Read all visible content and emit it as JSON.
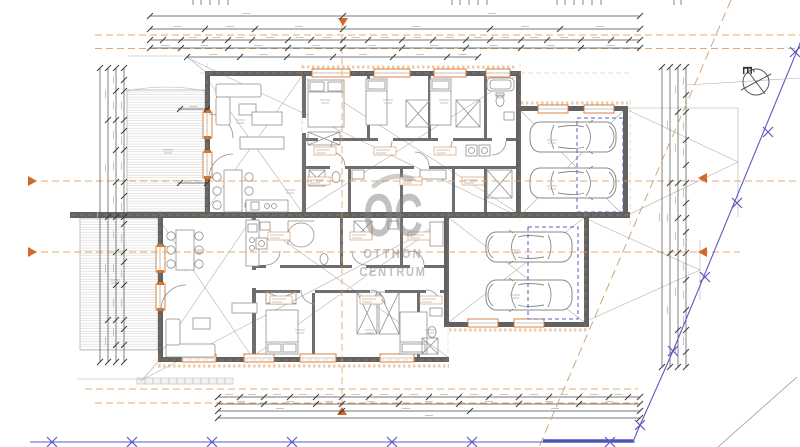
{
  "watermark": {
    "monogram": "OC",
    "line1": "OTTHON",
    "line2": "CENTRUM"
  },
  "north_label": "É",
  "plan": {
    "units": 2,
    "garages": 2,
    "cars": 4,
    "terraces": 2
  },
  "colors": {
    "wall_gray": "#616161",
    "line_gray": "#8f8f8f",
    "accent_orange": "#d4752c",
    "axis_orange": "#e09a55",
    "boundary_blue": "#5b5bc0",
    "diagonal_tan": "#cfa878",
    "watermark_gray": "#7f7f7f"
  }
}
